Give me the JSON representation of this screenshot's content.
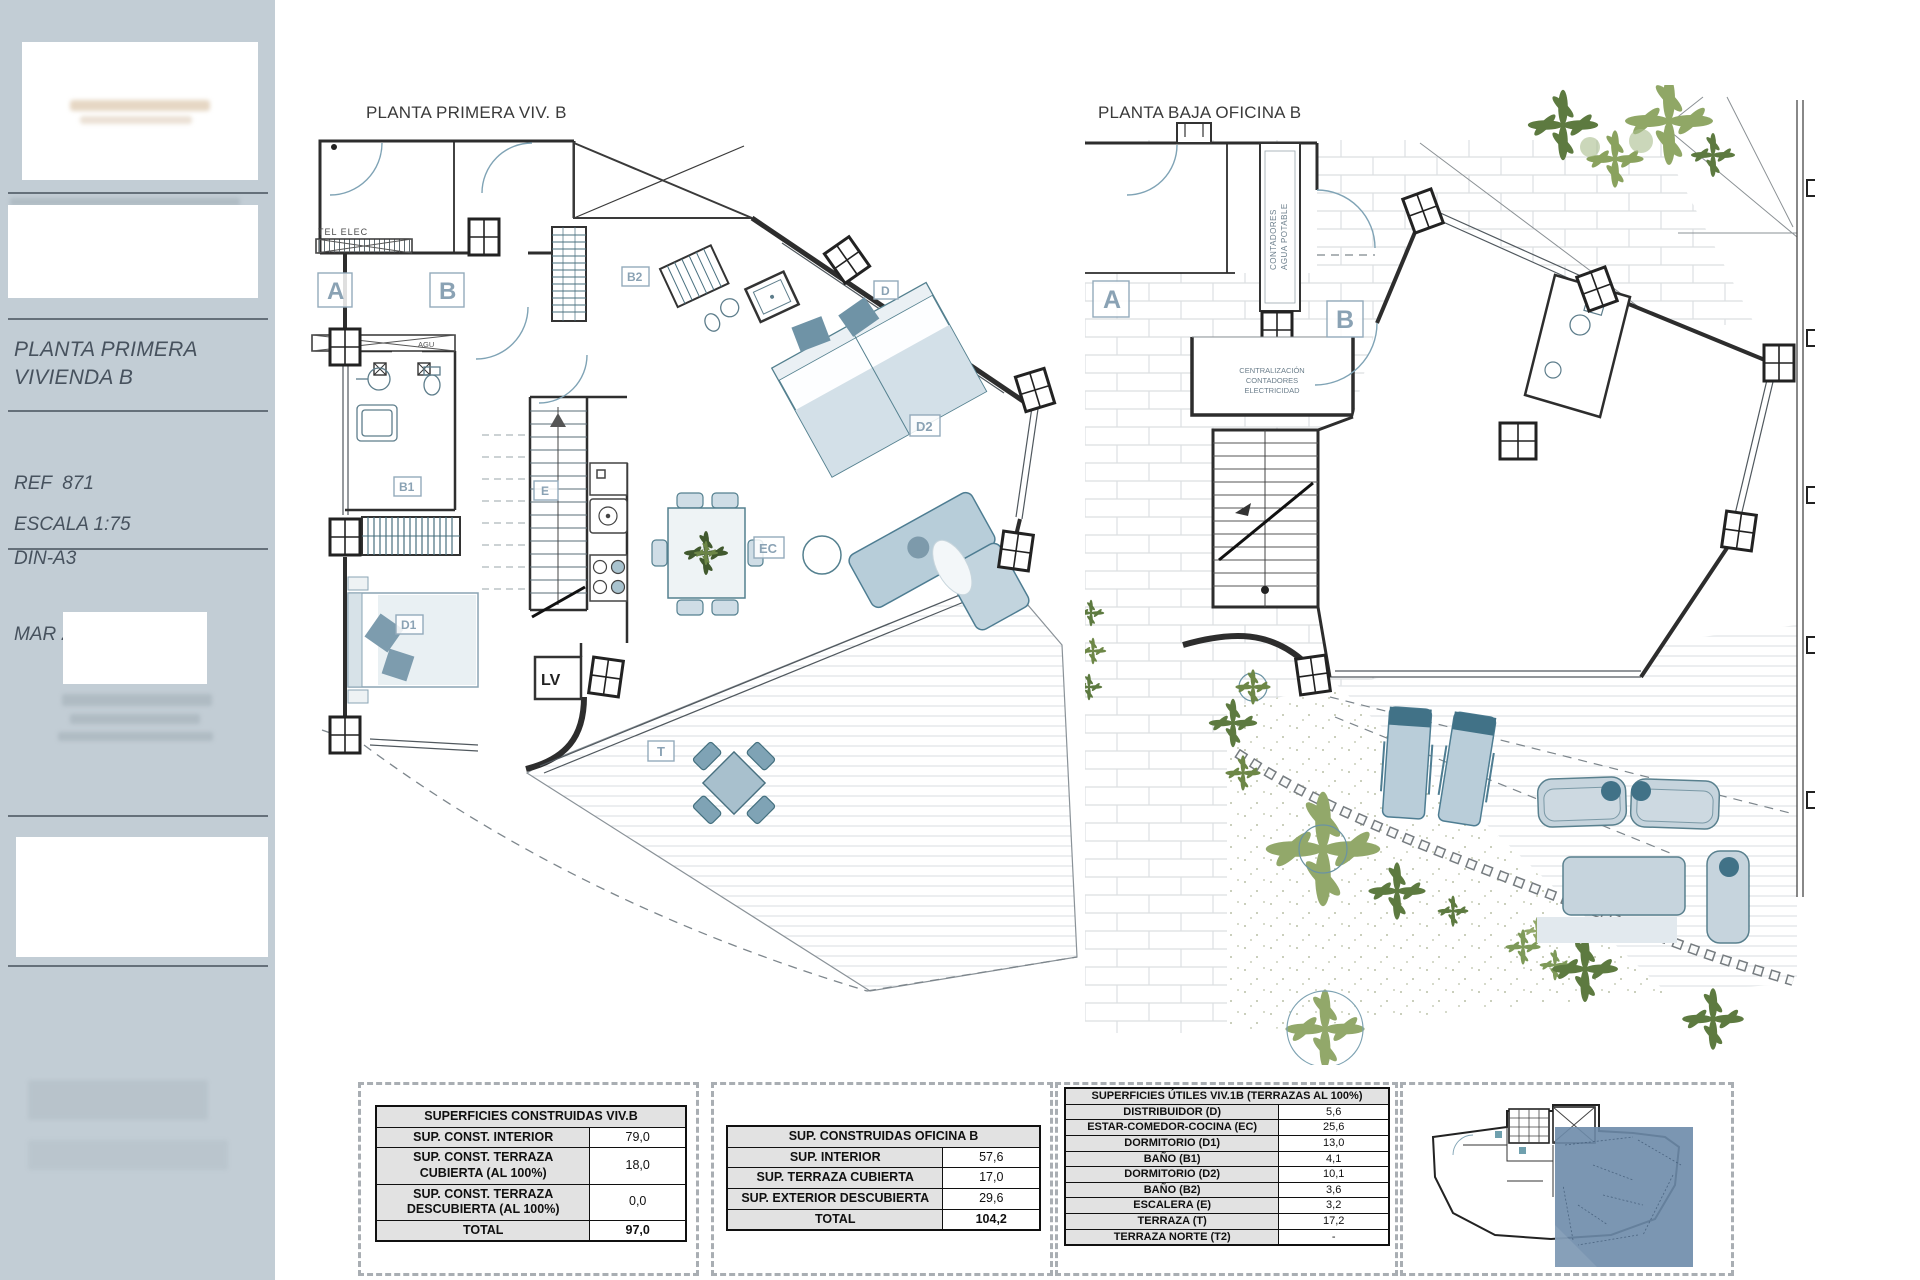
{
  "sidebar": {
    "title_line1": "PLANTA PRIMERA",
    "title_line2": "VIVIENDA B",
    "ref": "REF  871",
    "format": "DIN-A3",
    "date": "MAR 2025",
    "scale": "ESCALA 1:75"
  },
  "plan1": {
    "title": "PLANTA PRIMERA VIV. B",
    "labels": {
      "a": "A",
      "b": "B",
      "d": "D",
      "e": "E",
      "ec": "EC",
      "t": "T",
      "b1": "B1",
      "b2": "B2",
      "d1": "D1",
      "d2": "D2",
      "lv": "LV",
      "agu": "AGU",
      "tel_elec": "TEL  ELEC"
    }
  },
  "plan2": {
    "title": "PLANTA BAJA OFICINA B",
    "labels": {
      "a": "A",
      "b": "B"
    },
    "notes": {
      "contadores_line1": "CONTADORES",
      "contadores_line2": "AGUA POTABLE",
      "central_line1": "CENTRALIZACIÓN",
      "central_line2": "CONTADORES",
      "central_line3": "ELECTRICIDAD"
    }
  },
  "tables": {
    "viv_b": {
      "title": "SUPERFICIES CONSTRUIDAS VIV.B",
      "rows": [
        {
          "label": "SUP. CONST. INTERIOR",
          "value": "79,0"
        },
        {
          "label": "SUP. CONST. TERRAZA CUBIERTA (AL 100%)",
          "value": "18,0"
        },
        {
          "label": "SUP. CONST. TERRAZA DESCUBIERTA (AL 100%)",
          "value": "0,0"
        },
        {
          "label": "TOTAL",
          "value": "97,0"
        }
      ]
    },
    "oficina_b": {
      "title": "SUP. CONSTRUIDAS OFICINA B",
      "rows": [
        {
          "label": "SUP. INTERIOR",
          "value": "57,6"
        },
        {
          "label": "SUP. TERRAZA CUBIERTA",
          "value": "17,0"
        },
        {
          "label": "SUP. EXTERIOR DESCUBIERTA",
          "value": "29,6"
        },
        {
          "label": "TOTAL",
          "value": "104,2"
        }
      ]
    },
    "utiles": {
      "title": "SUPERFICIES ÚTILES VIV.1B (TERRAZAS AL 100%)",
      "rows": [
        {
          "label": "DISTRIBUIDOR (D)",
          "value": "5,6"
        },
        {
          "label": "ESTAR-COMEDOR-COCINA (EC)",
          "value": "25,6"
        },
        {
          "label": "DORMITORIO (D1)",
          "value": "13,0"
        },
        {
          "label": "BAÑO (B1)",
          "value": "4,1"
        },
        {
          "label": "DORMITORIO (D2)",
          "value": "10,1"
        },
        {
          "label": "BAÑO (B2)",
          "value": "3,6"
        },
        {
          "label": "ESCALERA (E)",
          "value": "3,2"
        },
        {
          "label": "TERRAZA (T)",
          "value": "17,2"
        },
        {
          "label": "TERRAZA NORTE (T2)",
          "value": "-"
        }
      ]
    }
  }
}
